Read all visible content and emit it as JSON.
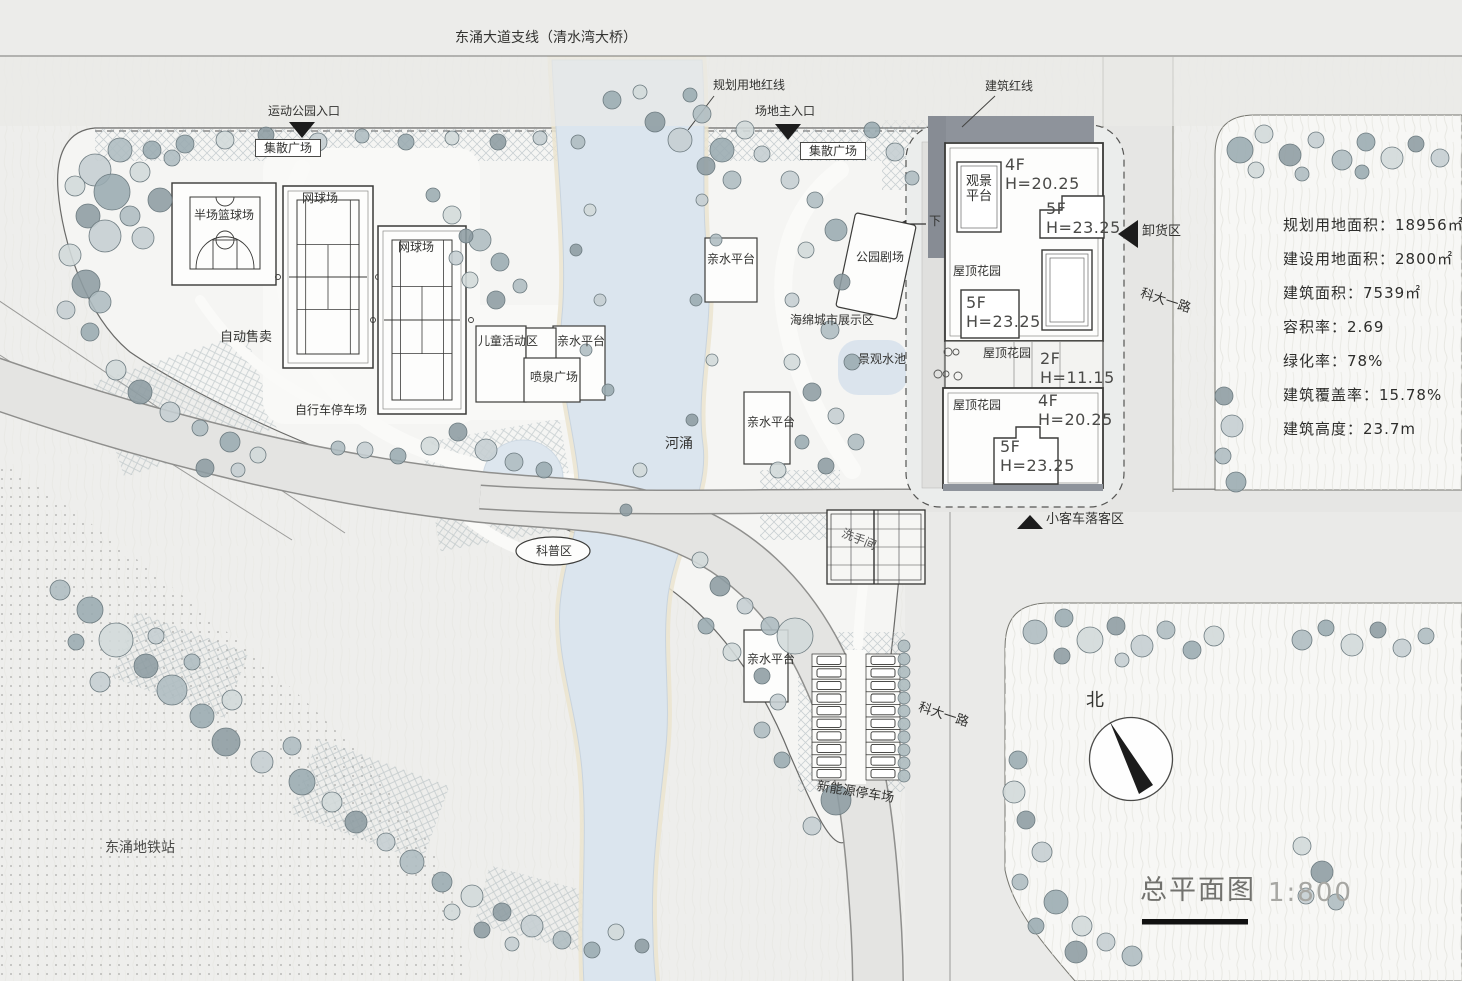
{
  "colors": {
    "paper": "#eeeeec",
    "park": "#f4f4f2",
    "road": "#e4e4e2",
    "water": "#dbe5ee",
    "tree": "#aebcc0",
    "building_shadow": "#8e939b",
    "accent_black": "#1c1c1c"
  },
  "roads": {
    "top": "东涌大道支线（清水湾大桥）",
    "keda": "科大一路"
  },
  "boundary": {
    "planning": "规划用地红线",
    "building": "建筑红线"
  },
  "entrances": {
    "park": "运动公园入口",
    "main": "场地主入口",
    "unloading": "卸货区",
    "dropoff": "小客车落客区",
    "ramp_down": "下"
  },
  "labels": {
    "plaza": "集散广场",
    "basketball": "半场篮球场",
    "tennis": "网球场",
    "vending": "自动售卖",
    "children": "儿童活动区",
    "fountain": "喷泉广场",
    "bike_parking": "自行车停车场",
    "river": "河涌",
    "science": "科普区",
    "theater": "公园剧场",
    "sponge": "海绵城市展示区",
    "pool": "景观水池",
    "waterfront": "亲水平台",
    "viewing_platform": "观景平台",
    "roof_garden": "屋顶花园",
    "restroom": "洗手间",
    "ev_parking": "新能源停车场",
    "metro": "东涌地铁站"
  },
  "buildings": {
    "floors_2": "2F",
    "floors_4": "4F",
    "floors_5": "5F",
    "height_2": "H=11.15",
    "height_4": "H=20.25",
    "height_5": "H=23.25"
  },
  "stats": {
    "items": [
      "规划用地面积：18956㎡",
      "建设用地面积：2800㎡",
      "建筑面积：7539㎡",
      "容积率：2.69",
      "绿化率：78%",
      "建筑覆盖率：15.78%",
      "建筑高度：23.7m"
    ]
  },
  "titleblock": {
    "title": "总平面图",
    "scale": "1:800",
    "north": "北"
  }
}
